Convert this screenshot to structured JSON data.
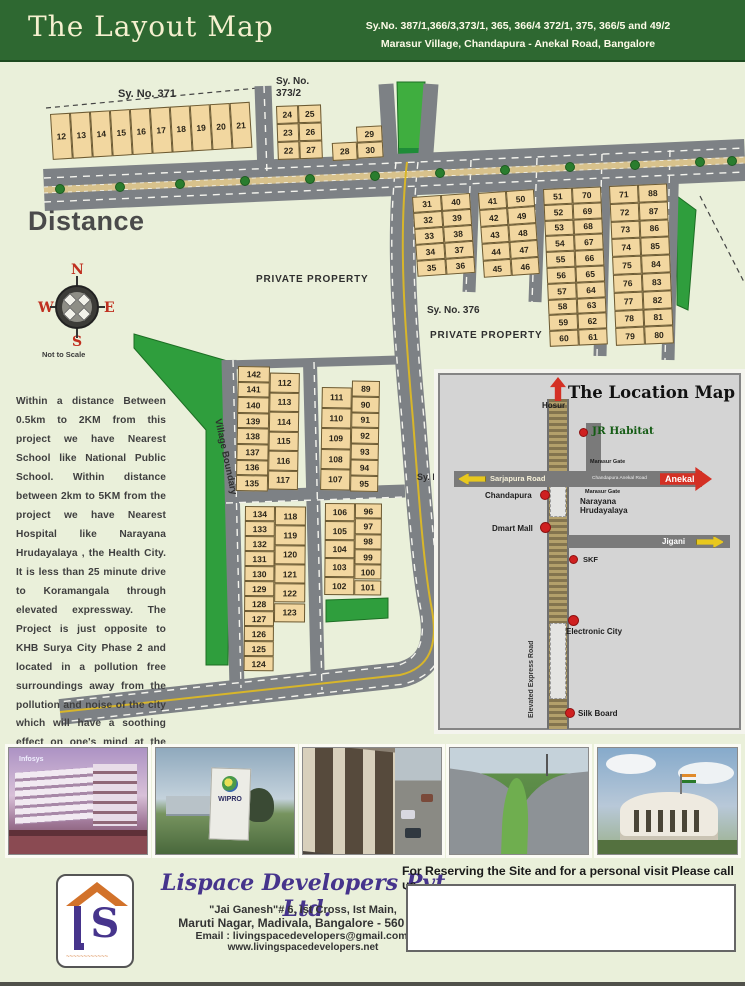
{
  "colors": {
    "header_green": "#2e6831",
    "page_bg": "#eaf0da",
    "plot_tan": "#f2d7a0",
    "road_gray": "#7d8185",
    "park_green": "#2f9e3d",
    "median_tan": "#d8c28c",
    "accent_red": "#d43024",
    "arrow_yellow": "#e8c81e",
    "logo_purple": "#46348c",
    "roof_orange": "#d2722a"
  },
  "header": {
    "title": "The Layout Map",
    "survey_line1": "Sy.No. 387/1,366/3,373/1, 365, 366/4 372/1, 375, 366/5 and 49/2",
    "survey_line2": "Marasur Village, Chandapura - Anekal Road, Bangalore"
  },
  "map": {
    "description": "Within a distance Between 0.5km to 2KM from this project we have Nearest School like National Public School. Within distance between 2km to 5KM from the project we have Nearest Hospital like Narayana Hrudayalaya , the Health City. It is less than 25 minute drive to Koramangala through elevated expressway. The Project is just opposite to KHB Surya City Phase 2 and located in a pollution free surroundings away from the pollution and noise of the city which will have a soothing effect on one's mind at the end of the day.",
    "compass": {
      "n": "N",
      "e": "E",
      "s": "S",
      "w": "W",
      "note": "Not to Scale"
    },
    "labels": [
      {
        "name": "sy-no-371",
        "x": 118,
        "y": 26,
        "fs": 11,
        "text": "Sy. No. 371"
      },
      {
        "name": "sy-no-373-2",
        "x": 276,
        "y": 14,
        "fs": 10,
        "text": "Sy. No.\n373/2"
      },
      {
        "name": "private-property-1",
        "x": 256,
        "y": 212,
        "fs": 10,
        "ls": 0.8,
        "text": "PRIVATE PROPERTY"
      },
      {
        "name": "sy-no-376",
        "x": 427,
        "y": 243,
        "fs": 10,
        "text": "Sy. No. 376"
      },
      {
        "name": "private-property-2",
        "x": 430,
        "y": 268,
        "fs": 10,
        "ls": 0.8,
        "text": "PRIVATE PROPERTY"
      },
      {
        "name": "sy-partial",
        "x": 417,
        "y": 410,
        "fs": 9,
        "text": "Sy. N"
      },
      {
        "name": "distance-heading",
        "x": 28,
        "y": 144,
        "fs": 27,
        "cls": "big",
        "text": "Distance"
      },
      {
        "name": "village-boundary",
        "x": 222,
        "y": 356,
        "fs": 9.5,
        "rot": 78,
        "text": "Village Boundary"
      }
    ],
    "blocks": [
      {
        "name": "sy371-row",
        "x": 50,
        "y": 52,
        "rot": -3.5,
        "h": {
          "cw": 20,
          "ch": 46,
          "cells": [
            "12",
            "13",
            "14",
            "15",
            "16",
            "17",
            "18",
            "19",
            "20",
            "21"
          ]
        }
      },
      {
        "name": "sy373-2",
        "x": 276,
        "y": 44,
        "rot": -2,
        "cols": [
          {
            "dx": 0,
            "dy": 0,
            "w": 22,
            "ch": 18,
            "cells": [
              "24",
              "23",
              "22"
            ]
          },
          {
            "dx": 22,
            "dy": 0,
            "w": 23,
            "ch": 18,
            "cells": [
              "25",
              "26",
              "27"
            ]
          }
        ]
      },
      {
        "name": "b28-30",
        "x": 331,
        "y": 66,
        "rot": -3,
        "cols": [
          {
            "dx": 0,
            "dy": 15,
            "w": 25,
            "ch": 18,
            "cells": [
              "28"
            ]
          },
          {
            "dx": 25,
            "dy": 0,
            "w": 26,
            "ch": 16,
            "cells": [
              "29",
              "30"
            ]
          }
        ]
      },
      {
        "name": "b31-40",
        "x": 412,
        "y": 135,
        "rot": -4,
        "cols": [
          {
            "dx": 0,
            "dy": 0,
            "w": 29,
            "ch": 16,
            "cells": [
              "31",
              "32",
              "33",
              "34",
              "35"
            ]
          },
          {
            "dx": 29,
            "dy": 0,
            "w": 29,
            "ch": 16,
            "cells": [
              "40",
              "39",
              "38",
              "37",
              "36"
            ]
          }
        ]
      },
      {
        "name": "b41-50",
        "x": 478,
        "y": 131,
        "rot": -4,
        "cols": [
          {
            "dx": 0,
            "dy": 0,
            "w": 28,
            "ch": 17,
            "cells": [
              "41",
              "42",
              "43",
              "44",
              "45"
            ]
          },
          {
            "dx": 28,
            "dy": 0,
            "w": 28,
            "ch": 17,
            "cells": [
              "50",
              "49",
              "48",
              "47",
              "46"
            ]
          }
        ]
      },
      {
        "name": "b51-70",
        "x": 543,
        "y": 127,
        "rot": -2.5,
        "cols": [
          {
            "dx": 0,
            "dy": 0,
            "w": 29,
            "ch": 15.8,
            "cells": [
              "51",
              "52",
              "53",
              "54",
              "55",
              "56",
              "57",
              "58",
              "59",
              "60"
            ]
          },
          {
            "dx": 29,
            "dy": 0,
            "w": 29,
            "ch": 15.8,
            "cells": [
              "70",
              "69",
              "68",
              "67",
              "66",
              "65",
              "64",
              "63",
              "62",
              "61"
            ]
          }
        ]
      },
      {
        "name": "b71-88",
        "x": 609,
        "y": 124,
        "rot": -2.5,
        "cols": [
          {
            "dx": 0,
            "dy": 0,
            "w": 29,
            "ch": 17.8,
            "cells": [
              "71",
              "72",
              "73",
              "74",
              "75",
              "76",
              "77",
              "78",
              "79"
            ]
          },
          {
            "dx": 29,
            "dy": 0,
            "w": 29,
            "ch": 17.8,
            "cells": [
              "88",
              "87",
              "86",
              "85",
              "84",
              "83",
              "82",
              "81",
              "80"
            ]
          }
        ]
      },
      {
        "name": "b135-142-112-117",
        "x": 238,
        "y": 304,
        "rot": 1,
        "cols": [
          {
            "dx": 0,
            "dy": 0,
            "w": 32,
            "ch": 15.6,
            "cells": [
              "142",
              "141",
              "140",
              "139",
              "138",
              "137",
              "136",
              "135"
            ]
          },
          {
            "dx": 32,
            "dy": 6,
            "w": 30,
            "ch": 19.5,
            "cells": [
              "112",
              "113",
              "114",
              "115",
              "116",
              "117"
            ]
          }
        ]
      },
      {
        "name": "b107-111-89-95",
        "x": 322,
        "y": 318,
        "rot": 1,
        "cols": [
          {
            "dx": 0,
            "dy": 7,
            "w": 30,
            "ch": 20.5,
            "cells": [
              "111",
              "110",
              "109",
              "108",
              "107"
            ]
          },
          {
            "dx": 30,
            "dy": 0,
            "w": 28,
            "ch": 15.8,
            "cells": [
              "89",
              "90",
              "91",
              "92",
              "93",
              "94",
              "95"
            ]
          }
        ]
      },
      {
        "name": "b124-134-118-123",
        "x": 245,
        "y": 444,
        "rot": 0.5,
        "cols": [
          {
            "dx": 0,
            "dy": 0,
            "w": 30,
            "ch": 15,
            "cells": [
              "134",
              "133",
              "132",
              "131",
              "130",
              "129",
              "128",
              "127",
              "126",
              "125",
              "124"
            ]
          },
          {
            "dx": 30,
            "dy": 0,
            "w": 31,
            "ch": 19.3,
            "cells": [
              "118",
              "119",
              "120",
              "121",
              "122",
              "123"
            ]
          }
        ]
      },
      {
        "name": "b96-106",
        "x": 325,
        "y": 441,
        "rot": 0.5,
        "cols": [
          {
            "dx": 0,
            "dy": 0,
            "w": 30,
            "ch": 18.4,
            "cells": [
              "106",
              "105",
              "104",
              "103",
              "102"
            ]
          },
          {
            "dx": 30,
            "dy": 0,
            "w": 27,
            "ch": 15.3,
            "cells": [
              "96",
              "97",
              "98",
              "99",
              "100",
              "101"
            ]
          }
        ]
      }
    ]
  },
  "location_map": {
    "title": "The Location Map",
    "hosur": "Hosur",
    "jr_habitat": "JR Habitat",
    "sarjapura_road": "Sarjapura Road",
    "chandapura_anekal_road": "Chandapura Anekal Road",
    "marasur_gate_top": "Marasur Gate",
    "marasur_gate_bottom": "Marasur Gate",
    "anekal": "Anekal",
    "chandapura": "Chandapura",
    "narayana": "Narayana\nHrudayalaya",
    "dmart_mall": "Dmart Mall",
    "jigani": "Jigani",
    "skf": "SKF",
    "electronic_city": "Electronic City",
    "elevated_express_road": "Elevated Express Road",
    "silk_board": "Silk Board"
  },
  "photos": [
    {
      "name": "infosys-campus",
      "label": "Infosys"
    },
    {
      "name": "wipro-sign",
      "label": "WIPRO"
    },
    {
      "name": "flyover-underpass",
      "label": ""
    },
    {
      "name": "elevated-expressway",
      "label": ""
    },
    {
      "name": "round-building-flag",
      "label": ""
    }
  ],
  "footer": {
    "company": "Lispace Developers Pvt. Ltd.",
    "address_line1": "\"Jai Ganesh\"# 6, Ist Cross, Ist Main,",
    "address_line2": "Maruti Nagar, Madivala, Bangalore - 560 068",
    "email_label": "Email :",
    "email": " livingspacedevelopers@gmail.com,",
    "website": "www.livingspacedevelopers.net",
    "call_heading": "For Reserving the Site and for a personal visit Please call us"
  }
}
